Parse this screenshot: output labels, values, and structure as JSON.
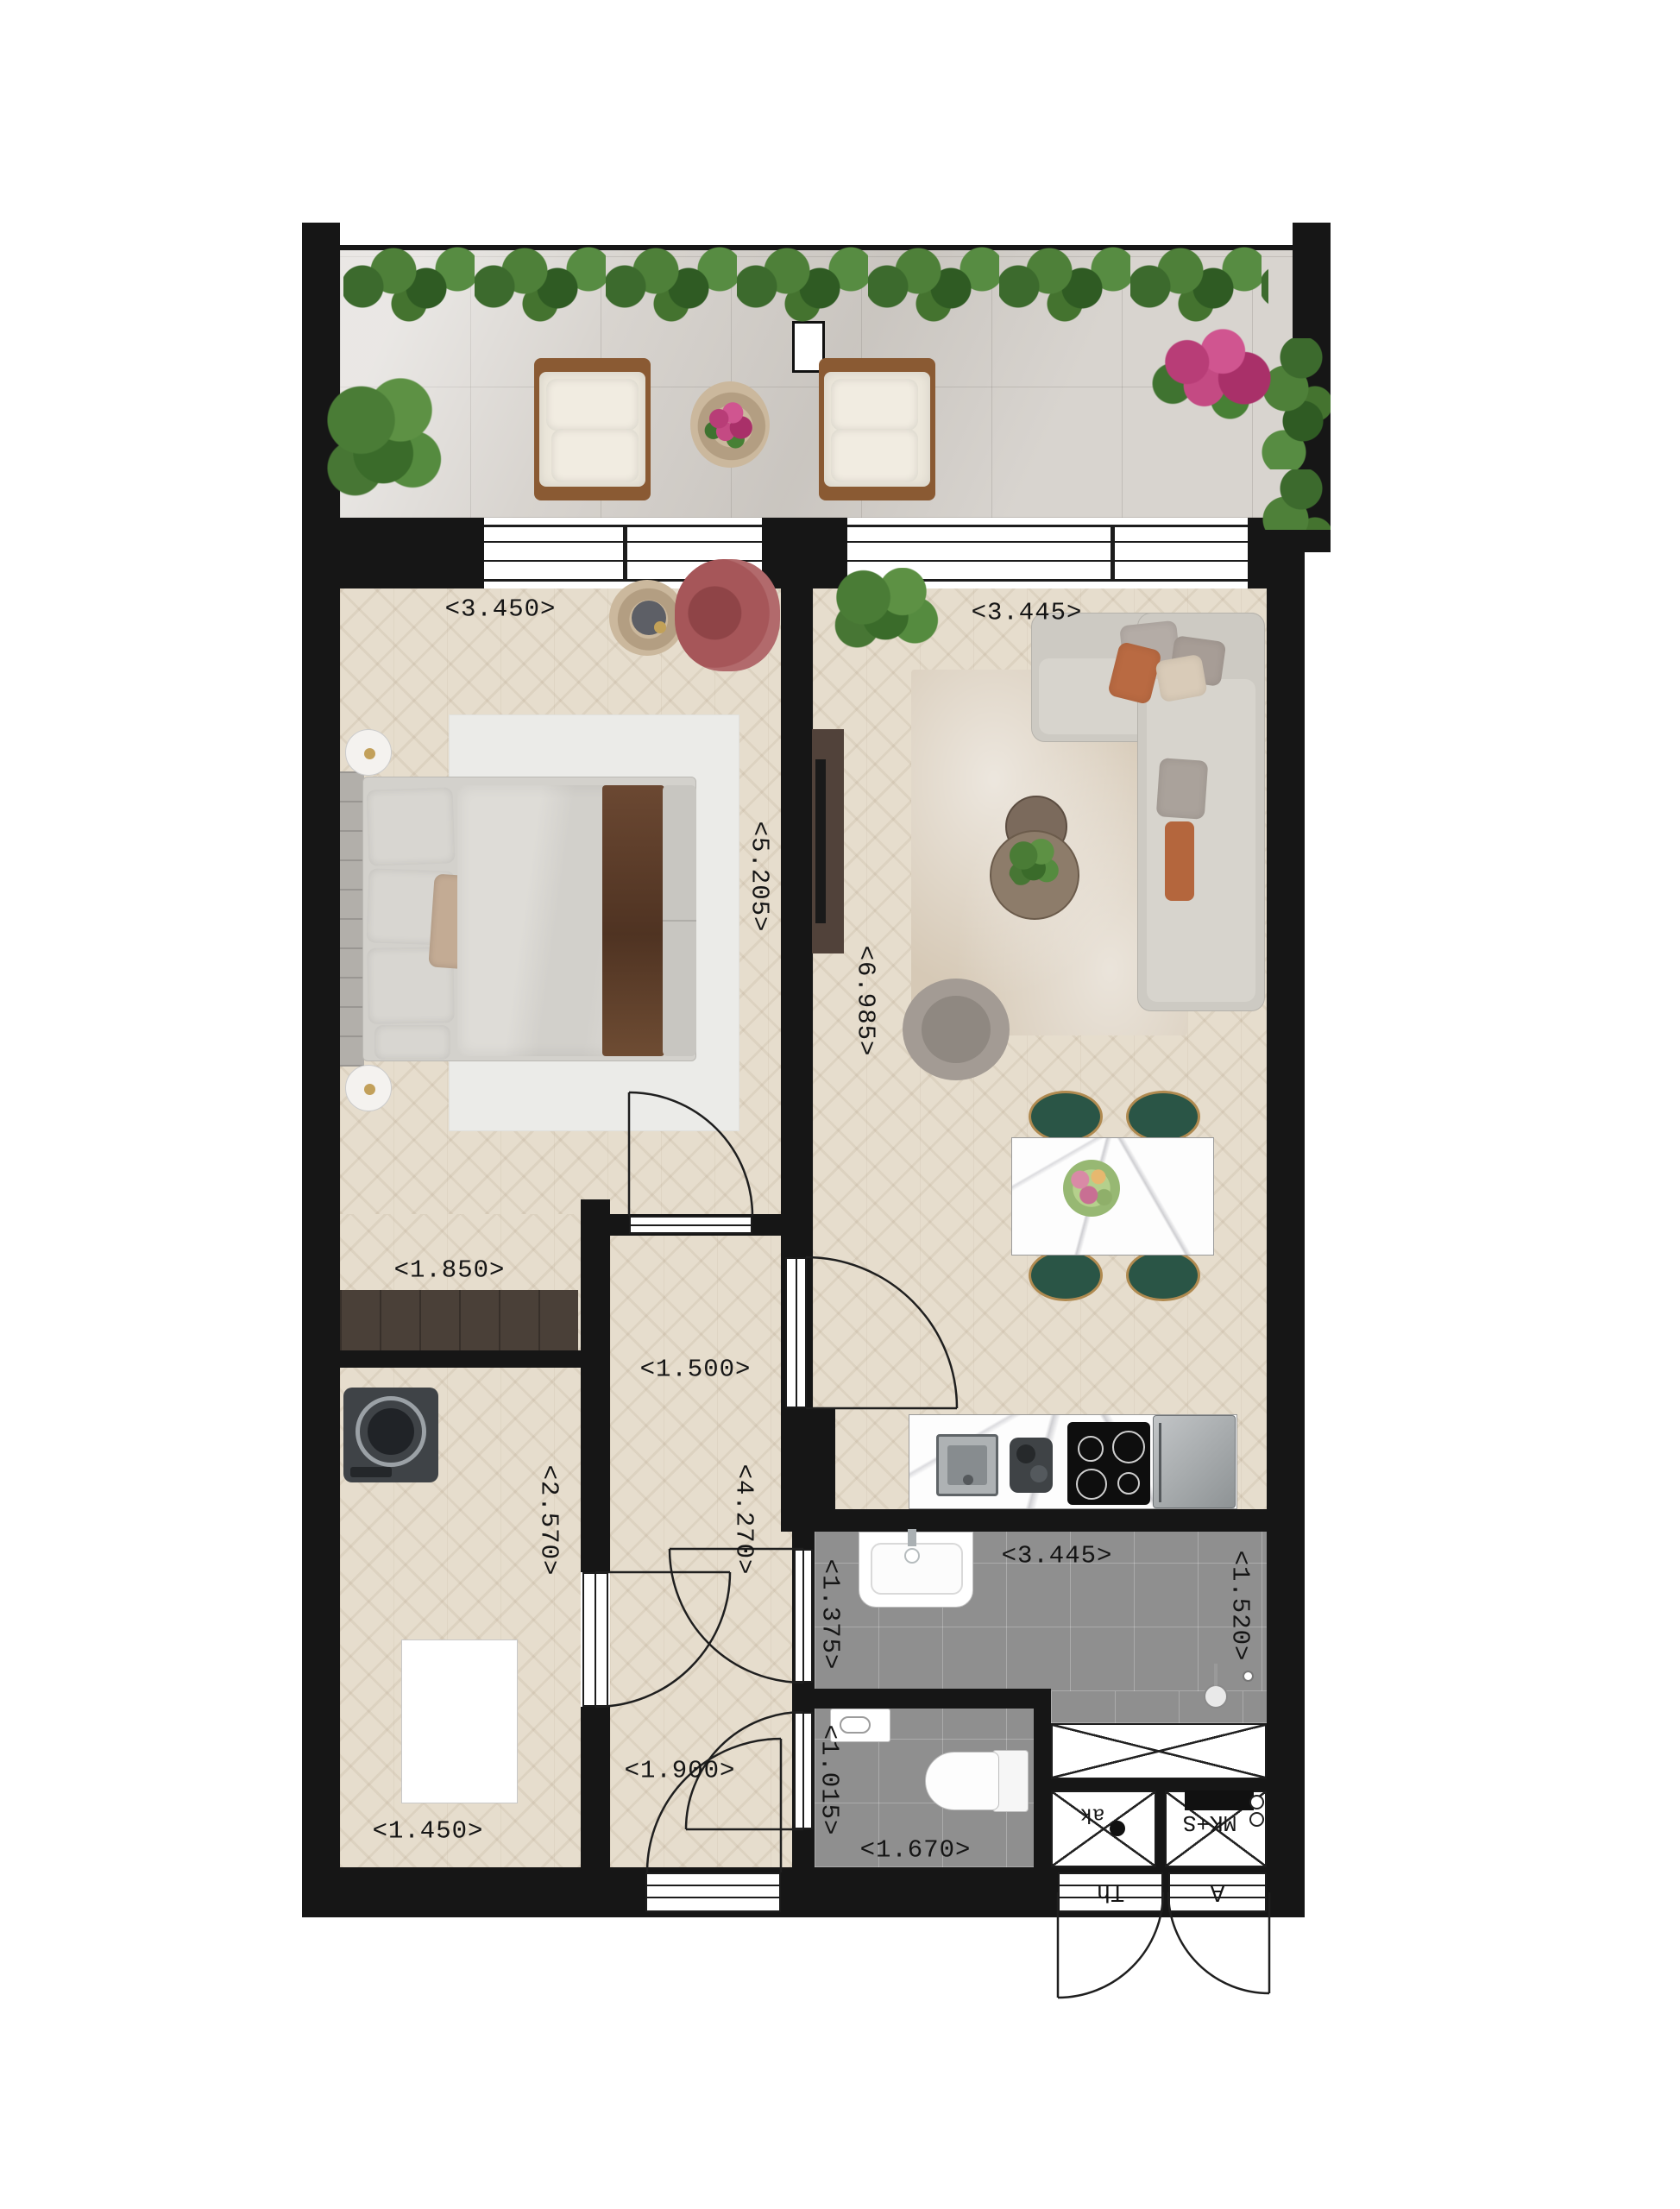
{
  "floorplan": {
    "dims": {
      "bedroom_width": "<3.450>",
      "bedroom_depth": "<5.205>",
      "bedroom_closet_width": "<1.850>",
      "living_width": "<3.445>",
      "living_depth": "<6.985>",
      "hall_width": "<1.500>",
      "hall_depth": "<4.270>",
      "hall_lower_width": "<1.900>",
      "utility_depth": "<2.570>",
      "utility_width": "<1.450>",
      "bathroom_width": "<3.445>",
      "bathroom_depth_left": "<1.375>",
      "bathroom_depth_right": "<1.520>",
      "wc_depth": "<1.015>",
      "wc_width": "<1.670>"
    },
    "tech_labels": {
      "shaft_left": "ak",
      "shaft_right": "MK+S",
      "door_left": "Th",
      "door_right": "A"
    }
  }
}
